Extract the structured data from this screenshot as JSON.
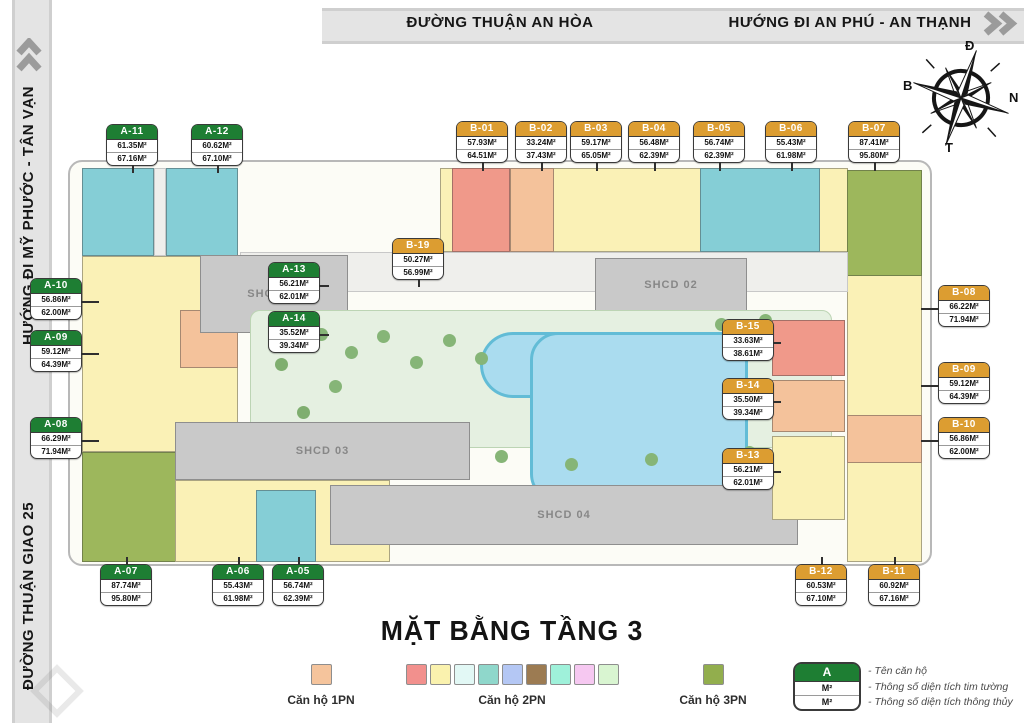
{
  "streets": {
    "top": "ĐƯỜNG THUẬN AN HÒA",
    "top_right": "HƯỚNG ĐI AN PHÚ - AN THẠNH",
    "left_top": "HƯỚNG ĐI MỸ PHƯỚC - TÂN VẠN",
    "left_bottom": "ĐƯỜNG THUẬN GIAO 25"
  },
  "compass": {
    "top": "Đ",
    "right": "N",
    "bottom": "T",
    "left": "B"
  },
  "title": "MẶT BẰNG TẦNG 3",
  "rooms": {
    "shcd01": "SHCD 01",
    "shcd02": "SHCD 02",
    "shcd03": "SHCD 03",
    "shcd04": "SHCD 04"
  },
  "callouts": [
    {
      "id": "A-11",
      "series": "a",
      "area1": "61.35M²",
      "area2": "67.16M²",
      "x": 106,
      "y": 124,
      "leader": {
        "dir": "down",
        "len": 8
      }
    },
    {
      "id": "A-12",
      "series": "a",
      "area1": "60.62M²",
      "area2": "67.10M²",
      "x": 191,
      "y": 124,
      "leader": {
        "dir": "down",
        "len": 8
      }
    },
    {
      "id": "B-01",
      "series": "b",
      "area1": "57.93M²",
      "area2": "64.51M²",
      "x": 456,
      "y": 121,
      "leader": {
        "dir": "down",
        "len": 9
      }
    },
    {
      "id": "B-02",
      "series": "b",
      "area1": "33.24M²",
      "area2": "37.43M²",
      "x": 515,
      "y": 121,
      "leader": {
        "dir": "down",
        "len": 9
      }
    },
    {
      "id": "B-03",
      "series": "b",
      "area1": "59.17M²",
      "area2": "65.05M²",
      "x": 570,
      "y": 121,
      "leader": {
        "dir": "down",
        "len": 9
      }
    },
    {
      "id": "B-04",
      "series": "b",
      "area1": "56.48M²",
      "area2": "62.39M²",
      "x": 628,
      "y": 121,
      "leader": {
        "dir": "down",
        "len": 9
      }
    },
    {
      "id": "B-05",
      "series": "b",
      "area1": "56.74M²",
      "area2": "62.39M²",
      "x": 693,
      "y": 121,
      "leader": {
        "dir": "down",
        "len": 9
      }
    },
    {
      "id": "B-06",
      "series": "b",
      "area1": "55.43M²",
      "area2": "61.98M²",
      "x": 765,
      "y": 121,
      "leader": {
        "dir": "down",
        "len": 9
      }
    },
    {
      "id": "B-07",
      "series": "b",
      "area1": "87.41M²",
      "area2": "95.80M²",
      "x": 848,
      "y": 121,
      "leader": {
        "dir": "down",
        "len": 9
      }
    },
    {
      "id": "A-10",
      "series": "a",
      "area1": "56.86M²",
      "area2": "62.00M²",
      "x": 30,
      "y": 278,
      "leader": {
        "dir": "right",
        "len": 18
      }
    },
    {
      "id": "A-09",
      "series": "a",
      "area1": "59.12M²",
      "area2": "64.39M²",
      "x": 30,
      "y": 330,
      "leader": {
        "dir": "right",
        "len": 18
      }
    },
    {
      "id": "A-08",
      "series": "a",
      "area1": "66.29M²",
      "area2": "71.94M²",
      "x": 30,
      "y": 417,
      "leader": {
        "dir": "right",
        "len": 18
      }
    },
    {
      "id": "A-13",
      "series": "a",
      "area1": "56.21M²",
      "area2": "62.01M²",
      "x": 268,
      "y": 262,
      "leader": {
        "dir": "right",
        "len": 10
      }
    },
    {
      "id": "A-14",
      "series": "a",
      "area1": "35.52M²",
      "area2": "39.34M²",
      "x": 268,
      "y": 311,
      "leader": {
        "dir": "right",
        "len": 10
      }
    },
    {
      "id": "B-19",
      "series": "b",
      "area1": "50.27M²",
      "area2": "56.99M²",
      "x": 392,
      "y": 238,
      "leader": {
        "dir": "down",
        "len": 8
      }
    },
    {
      "id": "B-15",
      "series": "b",
      "area1": "33.63M²",
      "area2": "38.61M²",
      "x": 722,
      "y": 319,
      "leader": {
        "dir": "right",
        "len": 8
      }
    },
    {
      "id": "B-14",
      "series": "b",
      "area1": "35.50M²",
      "area2": "39.34M²",
      "x": 722,
      "y": 378,
      "leader": {
        "dir": "right",
        "len": 8
      }
    },
    {
      "id": "B-13",
      "series": "b",
      "area1": "56.21M²",
      "area2": "62.01M²",
      "x": 722,
      "y": 448,
      "leader": {
        "dir": "right",
        "len": 8
      }
    },
    {
      "id": "B-08",
      "series": "b",
      "area1": "66.22M²",
      "area2": "71.94M²",
      "x": 938,
      "y": 285,
      "leader": {
        "dir": "left",
        "len": 18
      }
    },
    {
      "id": "B-09",
      "series": "b",
      "area1": "59.12M²",
      "area2": "64.39M²",
      "x": 938,
      "y": 362,
      "leader": {
        "dir": "left",
        "len": 18
      }
    },
    {
      "id": "B-10",
      "series": "b",
      "area1": "56.86M²",
      "area2": "62.00M²",
      "x": 938,
      "y": 417,
      "leader": {
        "dir": "left",
        "len": 18
      }
    },
    {
      "id": "A-07",
      "series": "a",
      "area1": "87.74M²",
      "area2": "95.80M²",
      "x": 100,
      "y": 564,
      "leader": {
        "dir": "up",
        "len": 8
      }
    },
    {
      "id": "A-06",
      "series": "a",
      "area1": "55.43M²",
      "area2": "61.98M²",
      "x": 212,
      "y": 564,
      "leader": {
        "dir": "up",
        "len": 8
      }
    },
    {
      "id": "A-05",
      "series": "a",
      "area1": "56.74M²",
      "area2": "62.39M²",
      "x": 272,
      "y": 564,
      "leader": {
        "dir": "up",
        "len": 8
      }
    },
    {
      "id": "B-12",
      "series": "b",
      "area1": "60.53M²",
      "area2": "67.10M²",
      "x": 795,
      "y": 564,
      "leader": {
        "dir": "up",
        "len": 8
      }
    },
    {
      "id": "B-11",
      "series": "b",
      "area1": "60.92M²",
      "area2": "67.16M²",
      "x": 868,
      "y": 564,
      "leader": {
        "dir": "up",
        "len": 8
      }
    }
  ],
  "legend": {
    "pn1": {
      "label": "Căn hộ 1PN",
      "colors": [
        "#f5c49c"
      ]
    },
    "pn2": {
      "label": "Căn hộ 2PN",
      "colors": [
        "#f2908d",
        "#faf2ae",
        "#e2f8f5",
        "#8fd7cb",
        "#b4c7f4",
        "#9c7b52",
        "#9ff1da",
        "#f6c8f1",
        "#d9f5d1"
      ]
    },
    "pn3": {
      "label": "Căn hộ 3PN",
      "colors": [
        "#92ae4d"
      ]
    },
    "key": {
      "name": "A",
      "row1": "M²",
      "row2": "M²",
      "lines": [
        "- Tên căn hộ",
        "- Thông số diện tích tim tường",
        "- Thông số diện tích thông thủy"
      ]
    }
  },
  "colors": {
    "series_a_header": "#1e7e33",
    "series_b_header": "#dc9d31",
    "pool": "#aadcef",
    "communal": "#c9c9c9"
  }
}
